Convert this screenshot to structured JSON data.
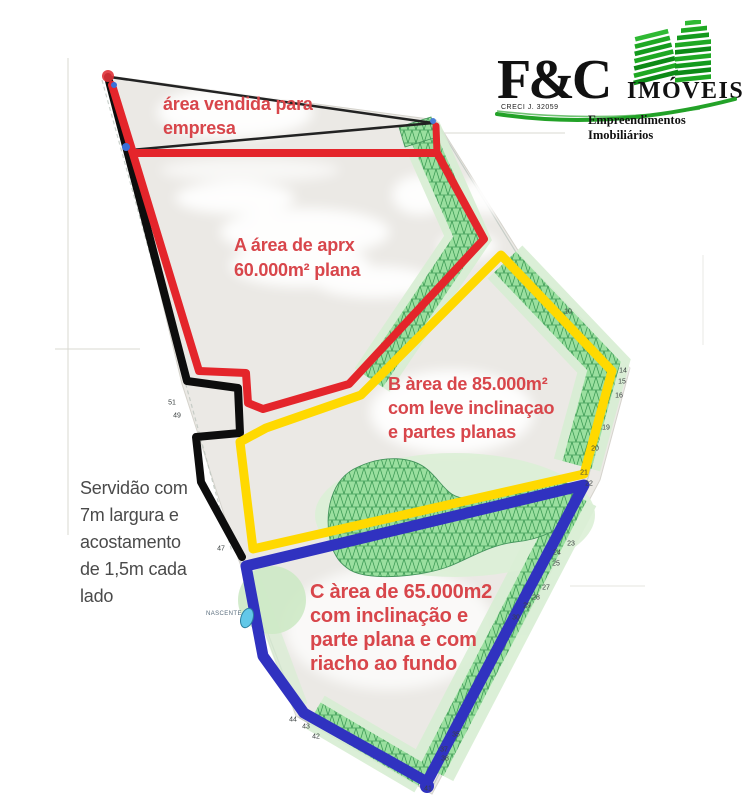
{
  "brand": {
    "name": "F&C",
    "word": "IMÓVEIS",
    "creci": "CRECI J. 32059",
    "tagline": "Empreendimentos Imobiliários"
  },
  "areas": {
    "sold": {
      "l1": "área vendida para",
      "l2": "empresa"
    },
    "a": {
      "l1": "A área de aprx",
      "l2": "60.000m² plana"
    },
    "b": {
      "l1": "B àrea  de 85.000m²",
      "l2": "com leve inclinaçao",
      "l3": "e partes planas"
    },
    "c": {
      "l1": "C àrea de 65.000m2",
      "l2": "com inclinação e",
      "l3": "parte plana e com",
      "l4": "riacho ao fundo"
    },
    "servidao": {
      "l1": "Servidão com",
      "l2": "7m largura e",
      "l3": "acostamento",
      "l4": "de 1,5m cada",
      "l5": "lado"
    }
  },
  "map": {
    "nascente_label": "NASCENTE",
    "plot_markers": [
      {
        "n": "10",
        "x": 568,
        "y": 312
      },
      {
        "n": "14",
        "x": 623,
        "y": 371
      },
      {
        "n": "15",
        "x": 622,
        "y": 382
      },
      {
        "n": "16",
        "x": 619,
        "y": 396
      },
      {
        "n": "19",
        "x": 606,
        "y": 428
      },
      {
        "n": "20",
        "x": 595,
        "y": 449
      },
      {
        "n": "21",
        "x": 584,
        "y": 473
      },
      {
        "n": "22",
        "x": 589,
        "y": 484
      },
      {
        "n": "23",
        "x": 571,
        "y": 544
      },
      {
        "n": "24",
        "x": 557,
        "y": 553
      },
      {
        "n": "25",
        "x": 556,
        "y": 564
      },
      {
        "n": "27",
        "x": 546,
        "y": 588
      },
      {
        "n": "28",
        "x": 536,
        "y": 598
      },
      {
        "n": "29",
        "x": 527,
        "y": 606
      },
      {
        "n": "30",
        "x": 516,
        "y": 618
      },
      {
        "n": "35",
        "x": 456,
        "y": 735
      },
      {
        "n": "37",
        "x": 444,
        "y": 750
      },
      {
        "n": "38",
        "x": 445,
        "y": 759
      },
      {
        "n": "41",
        "x": 428,
        "y": 789
      },
      {
        "n": "42",
        "x": 316,
        "y": 737
      },
      {
        "n": "43",
        "x": 306,
        "y": 727
      },
      {
        "n": "44",
        "x": 293,
        "y": 720
      },
      {
        "n": "47",
        "x": 221,
        "y": 549
      },
      {
        "n": "49",
        "x": 177,
        "y": 416
      },
      {
        "n": "51",
        "x": 172,
        "y": 403
      }
    ]
  },
  "colors": {
    "area_a_outline": "#e4252b",
    "area_b_outline": "#ffd900",
    "area_c_outline": "#3032c0",
    "servidao_line": "#0d0d0d",
    "triangle_line": "#222222",
    "vegetation_fill": "#9adf9f",
    "vegetation_line": "#2e8f49",
    "annotation_red": "#d8464b",
    "logo_green": "#1d9e23",
    "pond_blue": "#62c8e8"
  }
}
